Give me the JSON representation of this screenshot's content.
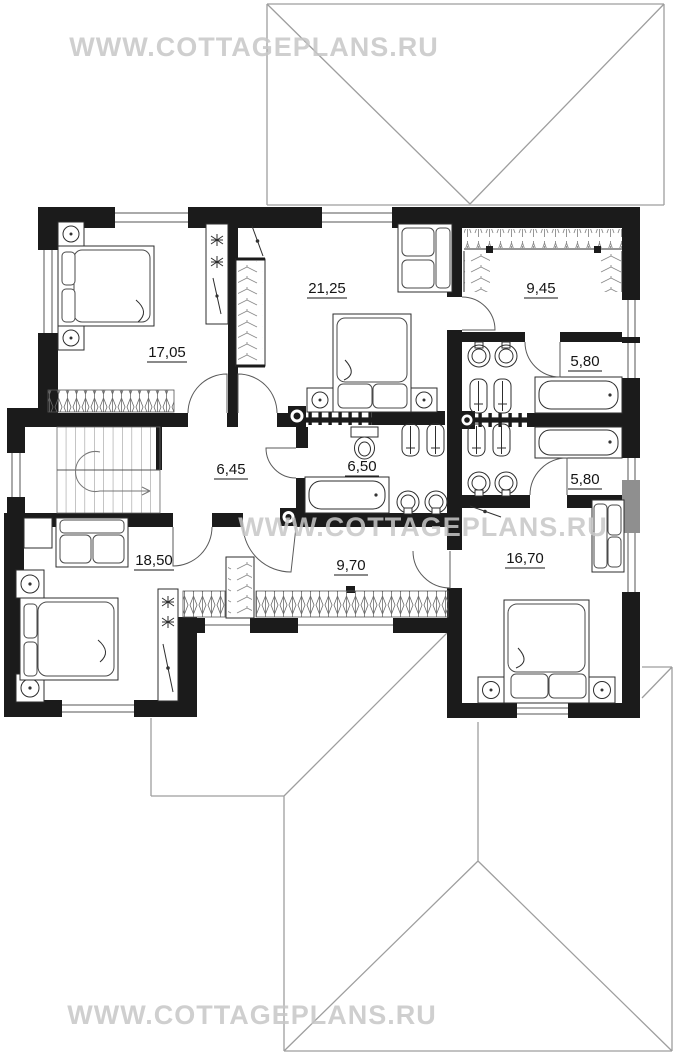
{
  "watermark": {
    "text": "WWW.COTTAGEPLANS.RU"
  },
  "rooms": [
    {
      "name": "bedroom-top-left",
      "area": "17,05"
    },
    {
      "name": "bedroom-top-middle",
      "area": "21,25"
    },
    {
      "name": "walk-in-closet",
      "area": "9,45"
    },
    {
      "name": "bathroom-top-right",
      "area": "5,80"
    },
    {
      "name": "hall-with-stairs",
      "area": "6,45"
    },
    {
      "name": "bathroom-middle",
      "area": "6,50"
    },
    {
      "name": "bathroom-right",
      "area": "5,80"
    },
    {
      "name": "bedroom-bottom-left",
      "area": "18,50"
    },
    {
      "name": "corridor",
      "area": "9,70"
    },
    {
      "name": "bedroom-bottom-right",
      "area": "16,70"
    }
  ],
  "colors": {
    "wall": "#1b1b1b",
    "roof_line": "#9e9e9e",
    "watermark": "#c7c7c7"
  }
}
